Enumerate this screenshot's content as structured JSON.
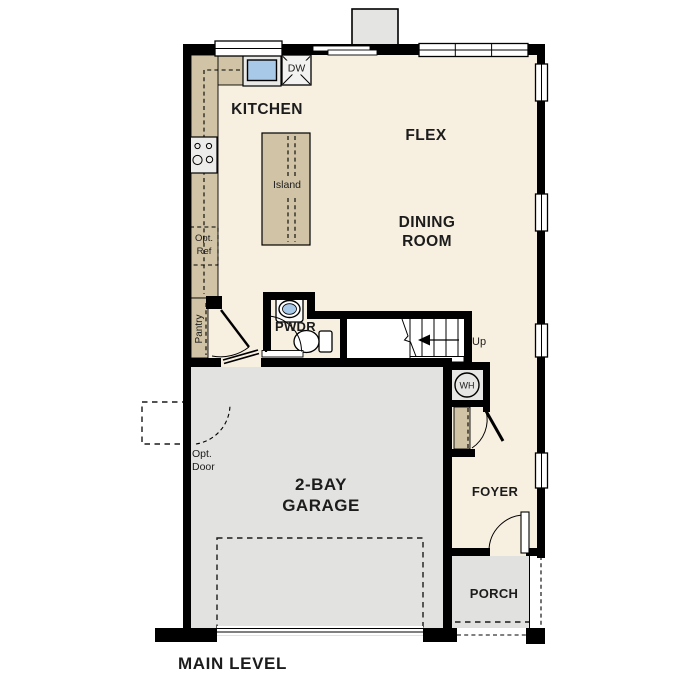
{
  "plan": {
    "title": "MAIN LEVEL",
    "rooms": {
      "kitchen": "KITCHEN",
      "flex": "FLEX",
      "dining1": "DINING",
      "dining2": "ROOM",
      "garage1": "2-BAY",
      "garage2": "GARAGE",
      "foyer": "FOYER",
      "porch": "PORCH",
      "pwdr": "PWDR",
      "pantry": "Pantry"
    },
    "fixtures": {
      "island": "Island",
      "dishwasher": "DW",
      "water_heater": "WH",
      "stairs_up": "Up",
      "opt_ref1": "Opt.",
      "opt_ref2": "Ref",
      "opt_door1": "Opt.",
      "opt_door2": "Door"
    },
    "colors": {
      "wall": "#000000",
      "floor": "#f7efe0",
      "garage_floor": "#e2e2e0",
      "porch_floor": "#e1e1df",
      "casework": "#d1c3a5",
      "appliance": "#ececea",
      "sink": "#a9c9e9",
      "bumpout": "#e4e4e2",
      "wh_box": "#e6e6e4"
    }
  }
}
